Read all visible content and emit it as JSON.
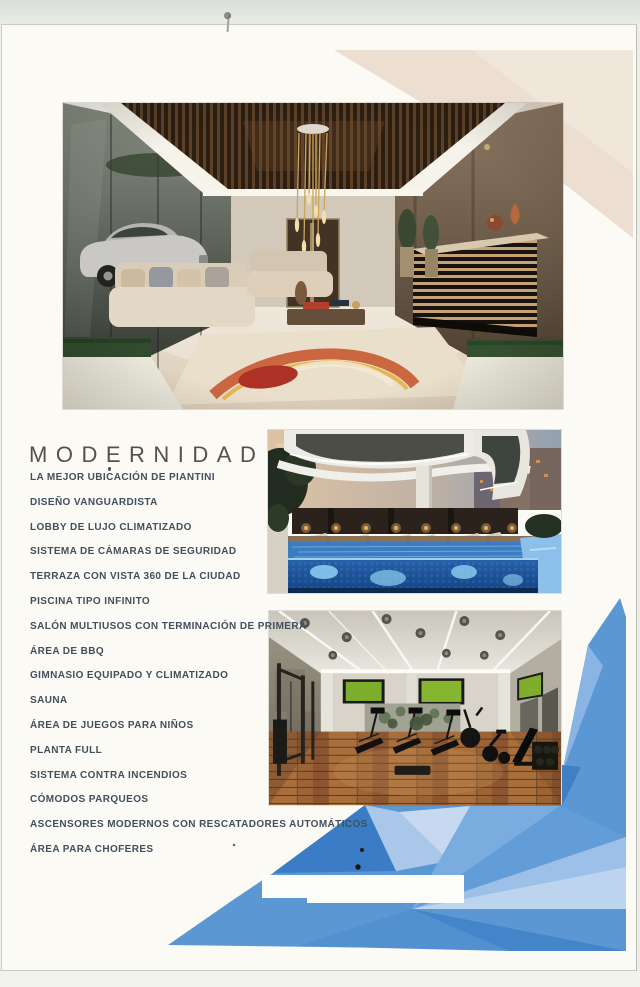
{
  "title": "MODERNIDAD",
  "amenities": [
    "LA MEJOR UBICACIÓN DE PIANTINI",
    "DISEÑO VANGUARDISTA",
    "LOBBY DE LUJO CLIMATIZADO",
    "SISTEMA DE CÁMARAS DE SEGURIDAD",
    "TERRAZA CON VISTA 360 DE LA CIUDAD",
    "PISCINA TIPO INFINITO",
    "SALÓN MULTIUSOS CON TERMINACIÓN DE PRIMERA",
    "ÁREA DE BBQ",
    "GIMNASIO EQUIPADO Y CLIMATIZADO",
    "SAUNA",
    "ÁREA DE JUEGOS PARA NIÑOS",
    "PLANTA FULL",
    "SISTEMA CONTRA INCENDIOS",
    "CÓMODOS PARQUEOS",
    "ASCENSORES MODERNOS CON RESCATADORES AUTOMÁTICOS",
    "ÁREA PARA CHOFERES"
  ],
  "photos": {
    "lobby": "lobby-photo",
    "pool": "infinity-pool-photo",
    "gym": "gym-photo"
  },
  "colors": {
    "paper": "#fbfaf5",
    "beige_deco": "#ecdfd1",
    "blue_main": "#5b97d3",
    "blue_dark": "#3a7cc5",
    "blue_light": "#a9c8e9",
    "title_text": "#56504a",
    "list_text": "#424f5c"
  }
}
